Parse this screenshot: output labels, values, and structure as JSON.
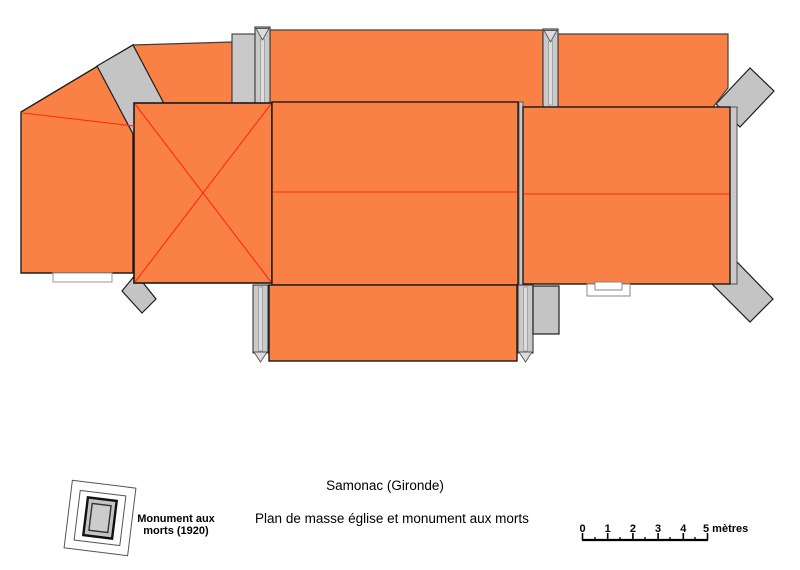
{
  "document": {
    "location": "Samonac (Gironde)",
    "caption": "Plan de masse église et monument aux morts"
  },
  "monument_legend": {
    "line1": "Monument aux",
    "line2": "morts (1920)"
  },
  "scale_bar": {
    "tick_labels": [
      "0",
      "1",
      "2",
      "3",
      "4"
    ],
    "end_label": "5 mètres"
  },
  "colors": {
    "roof": "#FA8145",
    "ridge": "#FF2A12",
    "stone": "#C4C4C4",
    "stone_light": "#C9C9C9",
    "outline": "#1E1E1E",
    "background": "#FFFFFF"
  }
}
